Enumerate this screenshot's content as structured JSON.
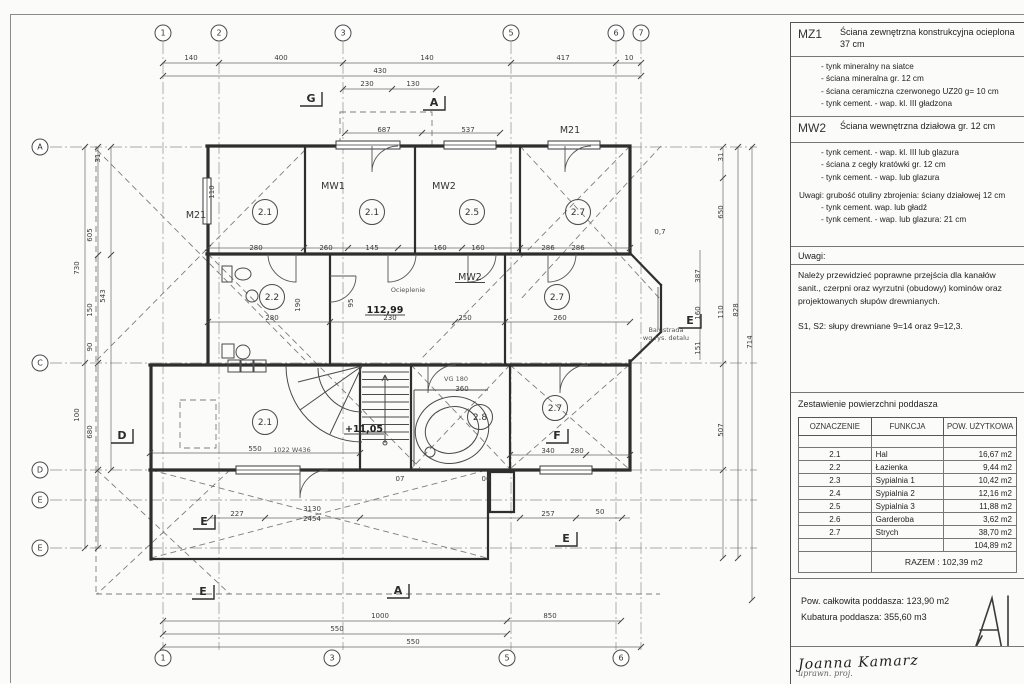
{
  "panel": {
    "mz1": {
      "code": "MZ1",
      "title": "Ściana zewnętrzna konstrukcyjna ocieplona 37 cm",
      "items": [
        "- tynk mineralny na siatce",
        "- ściana mineralna gr. 12 cm",
        "- ściana ceramiczna czerwonego UZ20 g= 10 cm",
        "- tynk cement. - wap. kl. III gładzona"
      ]
    },
    "mw2": {
      "code": "MW2",
      "title": "Ściana wewnętrzna działowa gr. 12 cm",
      "items": [
        "- tynk cement. - wap. kl. III lub glazura",
        "- ściana z cegły kratówki gr. 12 cm",
        "- tynk cement. - wap. lub glazura"
      ],
      "uwagi": "Uwagi: grubość otuliny zbrojenia: ściany działowej 12 cm",
      "uwagi_items": [
        "- tynk cement. wap. lub gładź",
        "- tynk cement. - wap. lub glazura: 21 cm"
      ]
    },
    "uwagi_header": "Uwagi:",
    "note1": "Należy przewidzieć poprawne przejścia dla kanałów sanit., czerpni oraz wyrzutni (obudowy) kominów oraz projektowanych słupów drewnianych.",
    "note2": "S1, S2: słupy drewniane 9=14 oraz 9=12,3.",
    "table": {
      "title": "Zestawienie powierzchni poddasza",
      "headers": [
        "OZNACZENIE",
        "FUNKCJA",
        "POW. UŻYTKOWA"
      ],
      "rows": [
        [
          "2.1",
          "Hal",
          "16,67 m2"
        ],
        [
          "2.2",
          "Łazienka",
          "9,44 m2"
        ],
        [
          "2.3",
          "Sypialnia 1",
          "10,42 m2"
        ],
        [
          "2.4",
          "Sypialnia 2",
          "12,16 m2"
        ],
        [
          "2.5",
          "Sypialnia 3",
          "11,88 m2"
        ],
        [
          "2.6",
          "Garderoba",
          "3,62 m2"
        ],
        [
          "2.7",
          "Strych",
          "38,70 m2"
        ]
      ],
      "subtotal": "104,89 m2",
      "razem": "RAZEM :  102,39 m2"
    },
    "totals": {
      "line1": "Pow. całkowita poddasza: 123,90 m2",
      "line2": "Kubatura poddasza: 355,60 m3"
    },
    "signature": {
      "name": "Joanna Kamarz",
      "line2": "uprawn. proj."
    }
  },
  "plan": {
    "grid_bubbles": {
      "top": [
        [
          "1",
          163
        ],
        [
          "2",
          219
        ],
        [
          "3",
          343
        ],
        [
          "5",
          511
        ],
        [
          "6",
          616
        ],
        [
          "7",
          641
        ]
      ],
      "top_y": 33,
      "bottom": [
        [
          "1",
          163
        ],
        [
          "3",
          332
        ],
        [
          "5",
          507
        ],
        [
          "6",
          621
        ]
      ],
      "bottom_y": 658,
      "left": [
        [
          "A",
          147
        ],
        [
          "C",
          363
        ],
        [
          "D",
          470
        ],
        [
          "E",
          500
        ],
        [
          "E",
          548
        ]
      ],
      "left_x": 40
    },
    "rooms": [
      {
        "t": "2.1",
        "x": 265,
        "y": 212
      },
      {
        "t": "2.1",
        "x": 372,
        "y": 212
      },
      {
        "t": "2.5",
        "x": 472,
        "y": 212
      },
      {
        "t": "2.7",
        "x": 578,
        "y": 212
      },
      {
        "t": "2.2",
        "x": 272,
        "y": 297
      },
      {
        "t": "2.7",
        "x": 557,
        "y": 297
      },
      {
        "t": "2.1",
        "x": 265,
        "y": 422
      },
      {
        "t": "2.8",
        "x": 480,
        "y": 417
      },
      {
        "t": "2.7",
        "x": 555,
        "y": 408
      }
    ],
    "wall_labels": [
      {
        "t": "M21",
        "x": 196,
        "y": 218
      },
      {
        "t": "MW1",
        "x": 333,
        "y": 189
      },
      {
        "t": "MW2",
        "x": 444,
        "y": 189
      },
      {
        "t": "M21",
        "x": 570,
        "y": 133
      },
      {
        "t": "MW2",
        "x": 470,
        "y": 280,
        "u": true
      }
    ],
    "markers": [
      {
        "t": "G",
        "x": 311,
        "y": 102
      },
      {
        "t": "A",
        "x": 434,
        "y": 106
      },
      {
        "t": "E",
        "x": 690,
        "y": 324
      },
      {
        "t": "D",
        "x": 122,
        "y": 439
      },
      {
        "t": "F",
        "x": 557,
        "y": 439
      },
      {
        "t": "E",
        "x": 204,
        "y": 525
      },
      {
        "t": "E",
        "x": 566,
        "y": 542
      },
      {
        "t": "E",
        "x": 203,
        "y": 595
      },
      {
        "t": "A",
        "x": 398,
        "y": 594
      }
    ],
    "levels": [
      {
        "t": "112,99",
        "x": 385,
        "y": 313
      },
      {
        "t": "+11,05",
        "x": 364,
        "y": 432
      }
    ],
    "small_labels": [
      {
        "t": "VG 180",
        "x": 456,
        "y": 381
      },
      {
        "t": "Balustrada",
        "x": 666,
        "y": 332
      },
      {
        "t": "wg rys. detalu",
        "x": 666,
        "y": 340
      },
      {
        "t": "Ocieplenie",
        "x": 408,
        "y": 292
      },
      {
        "t": "1022 W436",
        "x": 292,
        "y": 452
      }
    ],
    "dimensions": [
      {
        "t": "140",
        "x": 191,
        "y": 60
      },
      {
        "t": "400",
        "x": 281,
        "y": 60
      },
      {
        "t": "140",
        "x": 427,
        "y": 60
      },
      {
        "t": "417",
        "x": 563,
        "y": 60
      },
      {
        "t": "10",
        "x": 629,
        "y": 60
      },
      {
        "t": "430",
        "x": 380,
        "y": 73
      },
      {
        "t": "230",
        "x": 367,
        "y": 86
      },
      {
        "t": "130",
        "x": 413,
        "y": 86
      },
      {
        "t": "687",
        "x": 384,
        "y": 132
      },
      {
        "t": "537",
        "x": 468,
        "y": 132
      },
      {
        "t": "280",
        "x": 256,
        "y": 250
      },
      {
        "t": "260",
        "x": 326,
        "y": 250
      },
      {
        "t": "145",
        "x": 372,
        "y": 250
      },
      {
        "t": "160",
        "x": 440,
        "y": 250
      },
      {
        "t": "160",
        "x": 478,
        "y": 250
      },
      {
        "t": "286",
        "x": 548,
        "y": 250
      },
      {
        "t": "286",
        "x": 578,
        "y": 250
      },
      {
        "t": "280",
        "x": 272,
        "y": 320
      },
      {
        "t": "230",
        "x": 390,
        "y": 320
      },
      {
        "t": "250",
        "x": 465,
        "y": 320
      },
      {
        "t": "260",
        "x": 560,
        "y": 320
      },
      {
        "t": "550",
        "x": 255,
        "y": 451
      },
      {
        "t": "360",
        "x": 462,
        "y": 391
      },
      {
        "t": "340",
        "x": 548,
        "y": 453
      },
      {
        "t": "280",
        "x": 577,
        "y": 453
      },
      {
        "t": "227",
        "x": 237,
        "y": 516
      },
      {
        "t": "3130",
        "x": 312,
        "y": 511
      },
      {
        "t": "2454",
        "x": 312,
        "y": 521
      },
      {
        "t": "257",
        "x": 548,
        "y": 516
      },
      {
        "t": "50",
        "x": 600,
        "y": 514
      },
      {
        "t": "07",
        "x": 400,
        "y": 481
      },
      {
        "t": "06",
        "x": 486,
        "y": 481
      },
      {
        "t": "1000",
        "x": 380,
        "y": 618
      },
      {
        "t": "850",
        "x": 550,
        "y": 618
      },
      {
        "t": "550",
        "x": 337,
        "y": 631
      },
      {
        "t": "550",
        "x": 413,
        "y": 644
      },
      {
        "t": "31",
        "x": 100,
        "y": 158,
        "rot": -90
      },
      {
        "t": "605",
        "x": 92,
        "y": 235,
        "rot": -90
      },
      {
        "t": "730",
        "x": 79,
        "y": 268,
        "rot": -90
      },
      {
        "t": "150",
        "x": 92,
        "y": 310,
        "rot": -90
      },
      {
        "t": "543",
        "x": 105,
        "y": 296,
        "rot": -90
      },
      {
        "t": "90",
        "x": 92,
        "y": 347,
        "rot": -90
      },
      {
        "t": "100",
        "x": 79,
        "y": 415,
        "rot": -90
      },
      {
        "t": "680",
        "x": 92,
        "y": 432,
        "rot": -90
      },
      {
        "t": "31",
        "x": 723,
        "y": 157,
        "rot": -90
      },
      {
        "t": "650",
        "x": 723,
        "y": 212,
        "rot": -90
      },
      {
        "t": "110",
        "x": 723,
        "y": 312,
        "rot": -90
      },
      {
        "t": "507",
        "x": 723,
        "y": 430,
        "rot": -90
      },
      {
        "t": "828",
        "x": 738,
        "y": 310,
        "rot": -90
      },
      {
        "t": "714",
        "x": 752,
        "y": 342,
        "rot": -90
      },
      {
        "t": "387",
        "x": 700,
        "y": 276,
        "rot": -90
      },
      {
        "t": "160",
        "x": 700,
        "y": 313,
        "rot": -90
      },
      {
        "t": "151",
        "x": 700,
        "y": 348,
        "rot": -90
      },
      {
        "t": "0,7",
        "x": 660,
        "y": 234
      },
      {
        "t": "190",
        "x": 300,
        "y": 305,
        "rot": -90
      },
      {
        "t": "95",
        "x": 353,
        "y": 303,
        "rot": -90
      },
      {
        "t": "110",
        "x": 214,
        "y": 192,
        "rot": -90
      }
    ]
  }
}
